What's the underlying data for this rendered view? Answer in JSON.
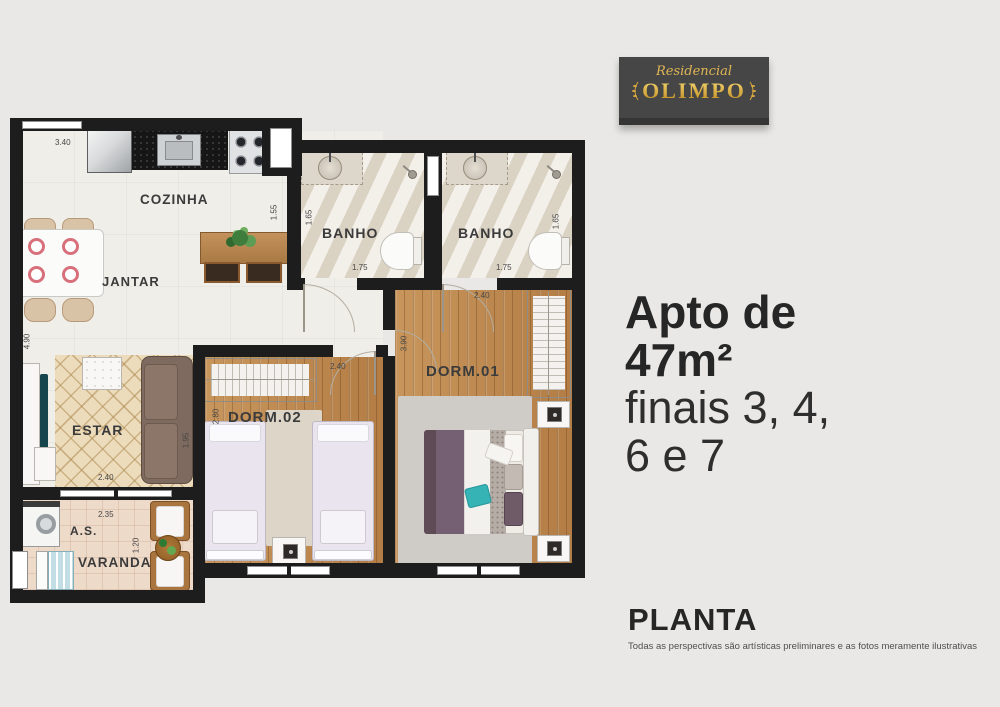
{
  "colors": {
    "background": "#e9e8e6",
    "wall": "#1d1d1d",
    "gold": "#d8a83e",
    "logo_background": "#464646",
    "headline_text": "#262626"
  },
  "logo": {
    "brand_script": "Residencial",
    "brand_name": "OLIMPO"
  },
  "headline": {
    "bold1": "Apto de",
    "bold2": "47m²",
    "light1": "finais 3, 4,",
    "light2": "6 e 7"
  },
  "footer": {
    "title": "PLANTA",
    "disclaimer": "Todas as perspectivas são artísticas preliminares e as fotos meramente ilustrativas"
  },
  "plan": {
    "labels": {
      "cozinha": "COZINHA",
      "jantar": "JANTAR",
      "estar": "ESTAR",
      "banho1": "BANHO",
      "banho2": "BANHO",
      "dorm1": "DORM.01",
      "dorm2": "DORM.02",
      "area_servico": "A.S.",
      "varanda": "VARANDA"
    },
    "dims": {
      "cozinha_largura": "3.40",
      "hall_entrada": "1.55",
      "banho1_prof": "1.65",
      "banho1_larg": "1.75",
      "banho2_prof": "1.65",
      "banho2_larg": "1.75",
      "sala_comprimento": "4.90",
      "estar_largura": "2.40",
      "estar_prof": "1.95",
      "dorm2_largura": "2.40",
      "dorm2_prof": "2.80",
      "dorm1_largura": "2.40",
      "dorm1_prof": "3.90",
      "as_largura": "2.35",
      "varanda_prof": "1.20"
    }
  }
}
